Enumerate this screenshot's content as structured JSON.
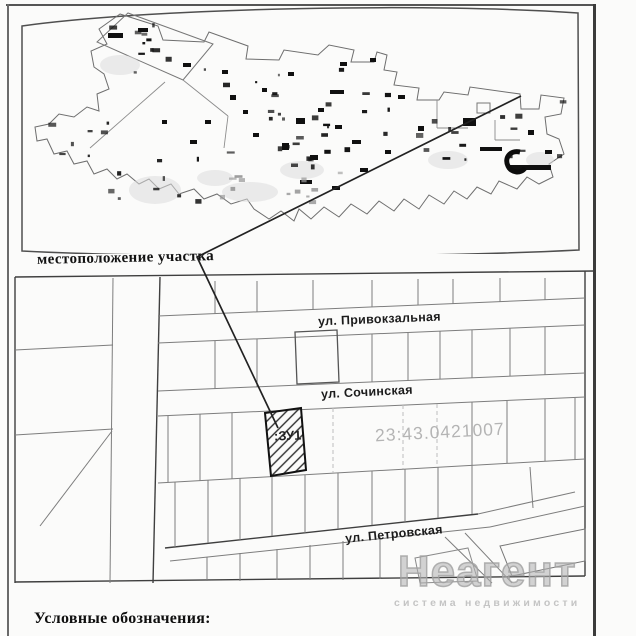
{
  "section_labels": {
    "overview": "местоположение участка",
    "legend": "Условные обозначения:"
  },
  "plot_map": {
    "streets": [
      {
        "label": "ул. Привокзальная"
      },
      {
        "label": "ул. Сочинская"
      },
      {
        "label": "ул. Петровская"
      }
    ],
    "parcel_label": ":ЗУ1",
    "cadastral_quarter_number": "23:43.0421007"
  },
  "watermark": {
    "brand": "Неагент",
    "tagline": "система недвижимости"
  },
  "colors": {
    "ink": "#1a1a1a",
    "grid_line": "#787878",
    "box_line": "#3f3f3f",
    "faded_label": "#b4b4b4",
    "watermark_gray": "#bdbdbd",
    "paper": "#fbfbfa"
  }
}
